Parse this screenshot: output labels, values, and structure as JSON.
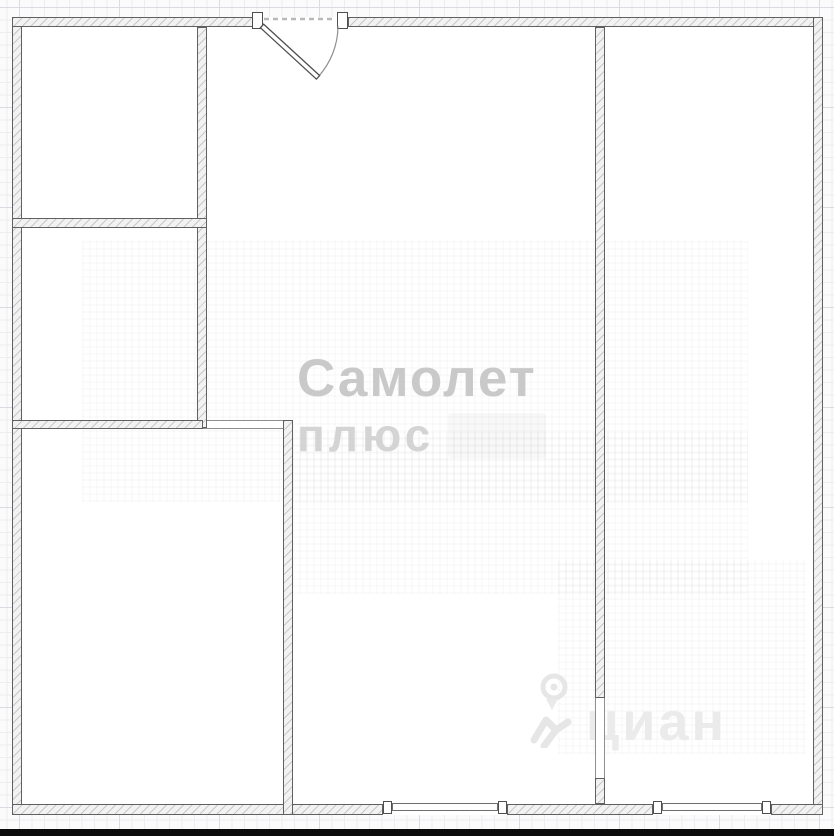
{
  "watermarks": {
    "samolet": {
      "line1": "Самолет",
      "line2": "плюс",
      "line1_color": "#c9c9c9",
      "line2_color": "#d4d4d4"
    },
    "cian": {
      "text": "циан",
      "icon": "cian-pin-logo",
      "color": "#ebebeb"
    }
  },
  "bottom_bar": {
    "color": "#0b0b0b"
  },
  "floorplan": {
    "wall_fill": "#f2f2f2",
    "wall_hatch": "#c8c8c8",
    "wall_border": "#606060",
    "walls": [
      {
        "name": "wall-exterior-left",
        "x": 12,
        "y": 17,
        "w": 10,
        "h": 798
      },
      {
        "name": "wall-exterior-top-left",
        "x": 12,
        "y": 17,
        "w": 241,
        "h": 10
      },
      {
        "name": "wall-exterior-top-right",
        "x": 348,
        "y": 17,
        "w": 475,
        "h": 10
      },
      {
        "name": "wall-exterior-right",
        "x": 813,
        "y": 17,
        "w": 10,
        "h": 798
      },
      {
        "name": "wall-exterior-bottom-left",
        "x": 12,
        "y": 804,
        "w": 371,
        "h": 11
      },
      {
        "name": "wall-exterior-bottom-mid",
        "x": 507,
        "y": 804,
        "w": 146,
        "h": 11
      },
      {
        "name": "wall-exterior-bottom-right",
        "x": 771,
        "y": 804,
        "w": 52,
        "h": 11
      },
      {
        "name": "wall-divider-left-rooms",
        "x": 197,
        "y": 27,
        "w": 10,
        "h": 401
      },
      {
        "name": "wall-left-rooms-horizontal",
        "x": 12,
        "y": 218,
        "w": 195,
        "h": 10
      },
      {
        "name": "wall-bottomleft-room-top",
        "x": 12,
        "y": 420,
        "w": 191,
        "h": 9
      },
      {
        "name": "wall-bottomleft-room-right",
        "x": 283,
        "y": 420,
        "w": 10,
        "h": 395
      },
      {
        "name": "wall-center-right-divider",
        "x": 595,
        "y": 27,
        "w": 10,
        "h": 671
      },
      {
        "name": "wall-center-right-divider-stub",
        "x": 595,
        "y": 778,
        "w": 10,
        "h": 26
      }
    ],
    "openings": [
      {
        "name": "passage-bottomleft-room",
        "x": 203,
        "y": 420,
        "w": 80,
        "h": 9,
        "orient": "h"
      },
      {
        "name": "doorway-right-room",
        "x": 595,
        "y": 698,
        "w": 10,
        "h": 80,
        "orient": "v"
      }
    ],
    "windows": [
      {
        "name": "window-bottom-left",
        "x": 392,
        "y": 803,
        "w": 106,
        "h": 8
      },
      {
        "name": "window-bottom-right",
        "x": 662,
        "y": 803,
        "w": 100,
        "h": 8
      }
    ],
    "caps": [
      {
        "name": "window-cap",
        "x": 383,
        "y": 801,
        "w": 9,
        "h": 13
      },
      {
        "name": "window-cap",
        "x": 498,
        "y": 801,
        "w": 9,
        "h": 13
      },
      {
        "name": "window-cap",
        "x": 653,
        "y": 801,
        "w": 9,
        "h": 13
      },
      {
        "name": "window-cap",
        "x": 762,
        "y": 801,
        "w": 9,
        "h": 13
      },
      {
        "name": "door-jamb-left",
        "x": 252,
        "y": 12,
        "w": 11,
        "h": 17
      },
      {
        "name": "door-jamb-right",
        "x": 337,
        "y": 12,
        "w": 11,
        "h": 17
      }
    ],
    "texture_bands": [
      {
        "name": "faint-texture-band",
        "x": 82,
        "y": 240,
        "w": 666,
        "h": 262
      },
      {
        "name": "faint-texture-band",
        "x": 292,
        "y": 432,
        "w": 456,
        "h": 162
      },
      {
        "name": "faint-texture-band",
        "x": 558,
        "y": 560,
        "w": 248,
        "h": 194
      }
    ],
    "entry_door": {
      "hinge_x": 262,
      "hinge_y": 26,
      "radius": 76,
      "swing_deg": 42.5
    }
  }
}
